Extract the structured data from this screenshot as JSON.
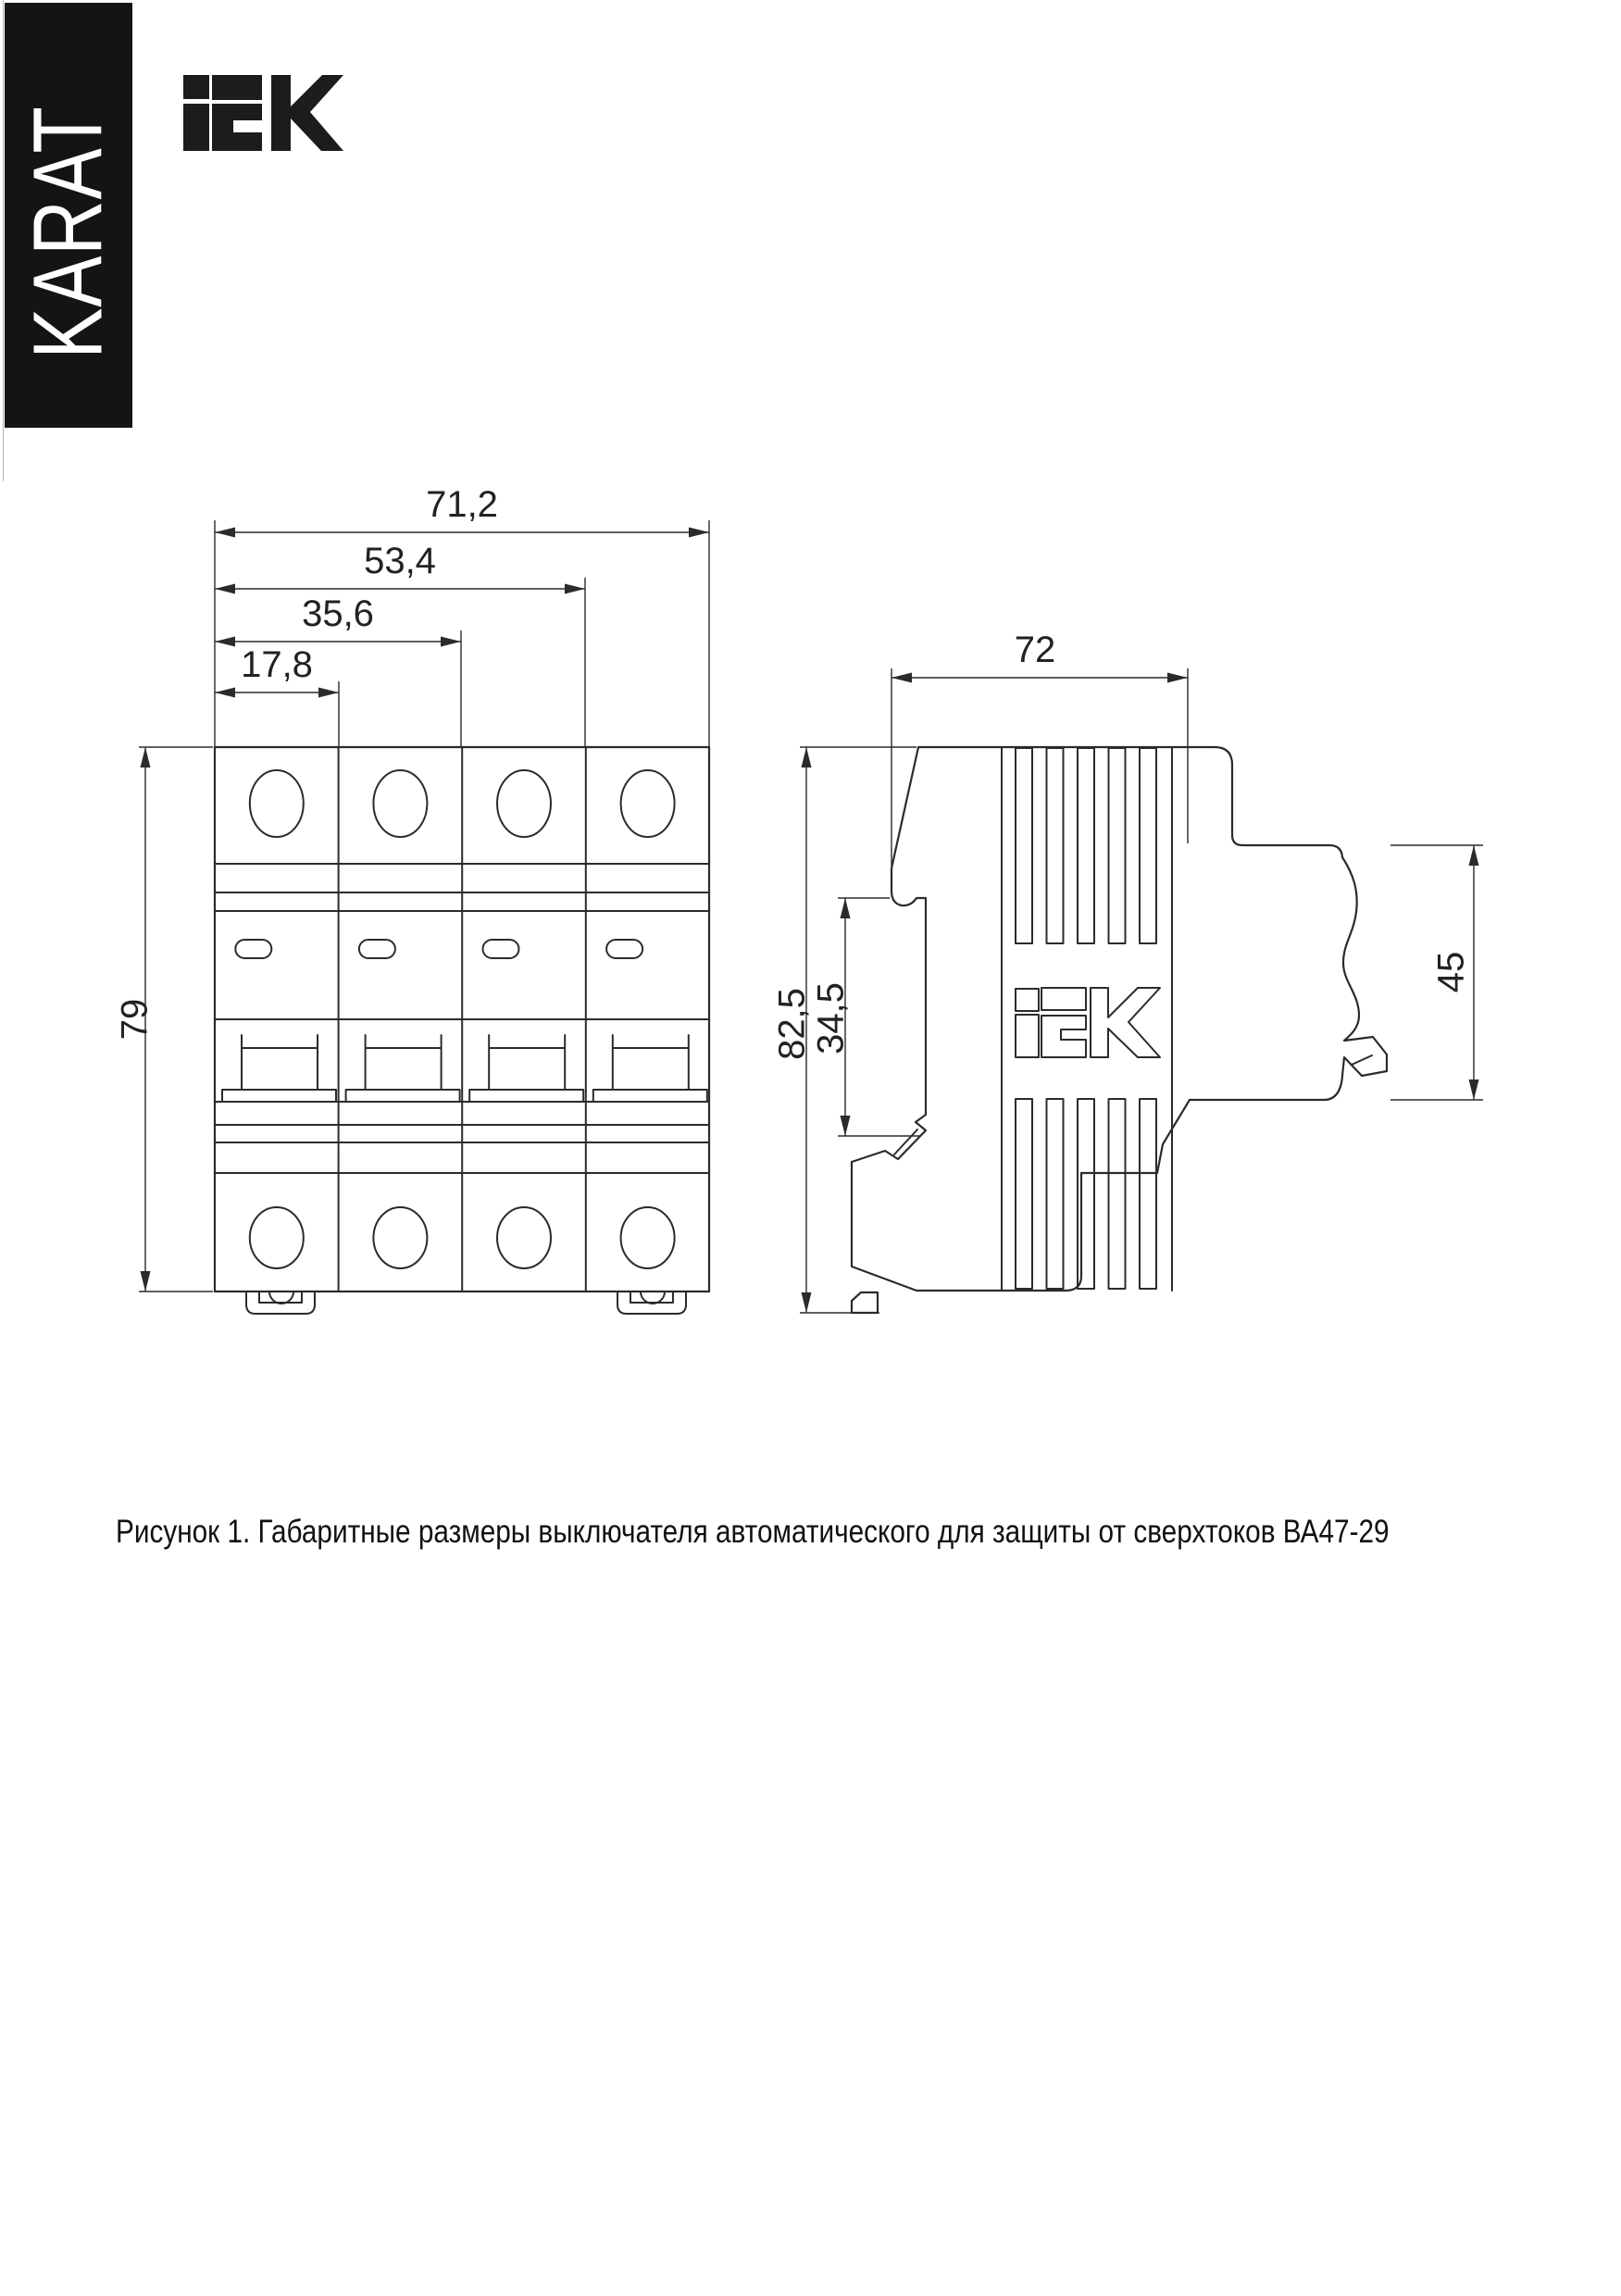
{
  "banner": {
    "text": "KARAT",
    "bg": "#141414",
    "fg": "#ffffff"
  },
  "brand": {
    "logo_text": "iEK"
  },
  "figure": {
    "caption": "Рисунок 1. Габаритные размеры выключателя автоматического для защиты от сверхтоков ВА47-29",
    "product": "ВА47-29"
  },
  "dimensions": {
    "front_width_total": "71,2",
    "front_width_three": "53,4",
    "front_width_two": "35,6",
    "front_width_one": "17,8",
    "front_height": "79",
    "side_depth": "72",
    "side_height": "82,5",
    "side_din_seat": "34,5",
    "side_terminal_height": "45"
  },
  "colors": {
    "line": "#2b2b2b",
    "banner_bg": "#141414",
    "logo": "#1c1c1c"
  }
}
